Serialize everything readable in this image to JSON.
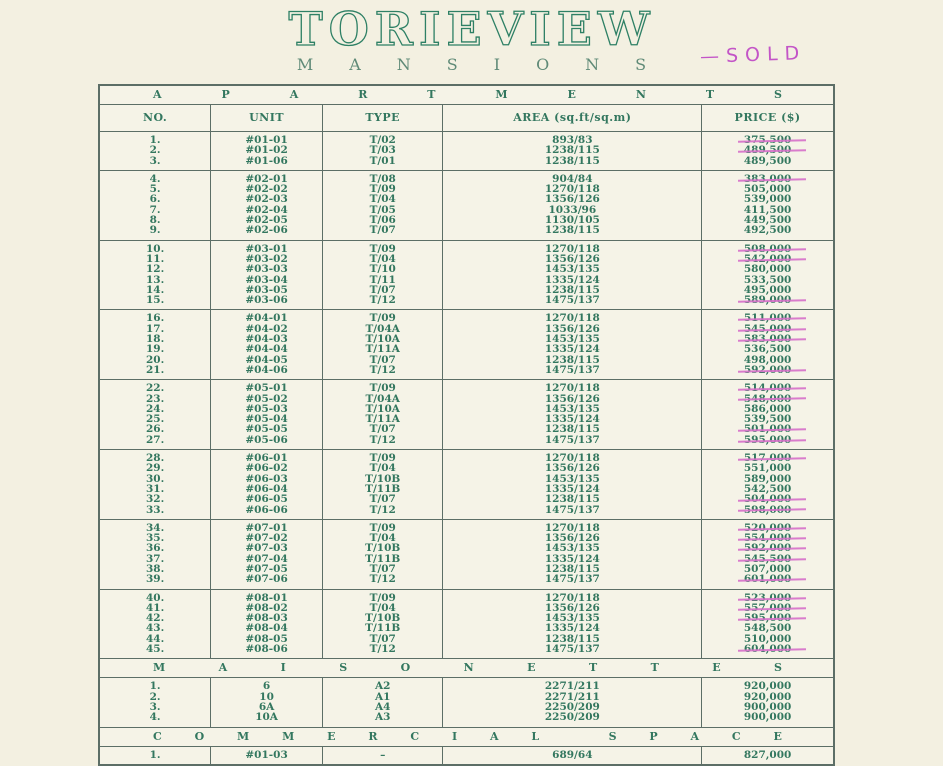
{
  "header": {
    "title": "TORIEVIEW",
    "subtitle": "MANSIONS",
    "sold_note": "—SOLD"
  },
  "colors": {
    "paper": "#f3f0e1",
    "ink_green": "#33775f",
    "border_green": "#5c6e66",
    "strike_pink": "#d66fc9",
    "sold_note_pink": "#c355c7"
  },
  "table": {
    "columns": [
      {
        "key": "no",
        "label": "NO."
      },
      {
        "key": "unit",
        "label": "UNIT"
      },
      {
        "key": "type",
        "label": "TYPE"
      },
      {
        "key": "area",
        "label": "AREA (sq.ft/sq.m)"
      },
      {
        "key": "price",
        "label": "PRICE ($)"
      }
    ],
    "sections": [
      {
        "id": "apartments",
        "title": "APARTMENTS",
        "show_columns": true,
        "groups": [
          [
            {
              "no": "1.",
              "unit": "#01-01",
              "type": "T/02",
              "area": "893/83",
              "price": "375,500",
              "sold": true
            },
            {
              "no": "2.",
              "unit": "#01-02",
              "type": "T/03",
              "area": "1238/115",
              "price": "489,500",
              "sold": true
            },
            {
              "no": "3.",
              "unit": "#01-06",
              "type": "T/01",
              "area": "1238/115",
              "price": "489,500",
              "sold": false
            }
          ],
          [
            {
              "no": "4.",
              "unit": "#02-01",
              "type": "T/08",
              "area": "904/84",
              "price": "383,000",
              "sold": true
            },
            {
              "no": "5.",
              "unit": "#02-02",
              "type": "T/09",
              "area": "1270/118",
              "price": "505,000",
              "sold": false
            },
            {
              "no": "6.",
              "unit": "#02-03",
              "type": "T/04",
              "area": "1356/126",
              "price": "539,000",
              "sold": false
            },
            {
              "no": "7.",
              "unit": "#02-04",
              "type": "T/05",
              "area": "1033/96",
              "price": "411,500",
              "sold": false
            },
            {
              "no": "8.",
              "unit": "#02-05",
              "type": "T/06",
              "area": "1130/105",
              "price": "449,500",
              "sold": false
            },
            {
              "no": "9.",
              "unit": "#02-06",
              "type": "T/07",
              "area": "1238/115",
              "price": "492,500",
              "sold": false
            }
          ],
          [
            {
              "no": "10.",
              "unit": "#03-01",
              "type": "T/09",
              "area": "1270/118",
              "price": "508,000",
              "sold": true
            },
            {
              "no": "11.",
              "unit": "#03-02",
              "type": "T/04",
              "area": "1356/126",
              "price": "542,000",
              "sold": true
            },
            {
              "no": "12.",
              "unit": "#03-03",
              "type": "T/10",
              "area": "1453/135",
              "price": "580,000",
              "sold": false
            },
            {
              "no": "13.",
              "unit": "#03-04",
              "type": "T/11",
              "area": "1335/124",
              "price": "533,500",
              "sold": false
            },
            {
              "no": "14.",
              "unit": "#03-05",
              "type": "T/07",
              "area": "1238/115",
              "price": "495,000",
              "sold": false
            },
            {
              "no": "15.",
              "unit": "#03-06",
              "type": "T/12",
              "area": "1475/137",
              "price": "589,000",
              "sold": true
            }
          ],
          [
            {
              "no": "16.",
              "unit": "#04-01",
              "type": "T/09",
              "area": "1270/118",
              "price": "511,000",
              "sold": true
            },
            {
              "no": "17.",
              "unit": "#04-02",
              "type": "T/04A",
              "area": "1356/126",
              "price": "545,000",
              "sold": true
            },
            {
              "no": "18.",
              "unit": "#04-03",
              "type": "T/10A",
              "area": "1453/135",
              "price": "583,000",
              "sold": true
            },
            {
              "no": "19.",
              "unit": "#04-04",
              "type": "T/11A",
              "area": "1335/124",
              "price": "536,500",
              "sold": false
            },
            {
              "no": "20.",
              "unit": "#04-05",
              "type": "T/07",
              "area": "1238/115",
              "price": "498,000",
              "sold": false
            },
            {
              "no": "21.",
              "unit": "#04-06",
              "type": "T/12",
              "area": "1475/137",
              "price": "592,000",
              "sold": true
            }
          ],
          [
            {
              "no": "22.",
              "unit": "#05-01",
              "type": "T/09",
              "area": "1270/118",
              "price": "514,000",
              "sold": true
            },
            {
              "no": "23.",
              "unit": "#05-02",
              "type": "T/04A",
              "area": "1356/126",
              "price": "548,000",
              "sold": true
            },
            {
              "no": "24.",
              "unit": "#05-03",
              "type": "T/10A",
              "area": "1453/135",
              "price": "586,000",
              "sold": false
            },
            {
              "no": "25.",
              "unit": "#05-04",
              "type": "T/11A",
              "area": "1335/124",
              "price": "539,500",
              "sold": false
            },
            {
              "no": "26.",
              "unit": "#05-05",
              "type": "T/07",
              "area": "1238/115",
              "price": "501,000",
              "sold": true
            },
            {
              "no": "27.",
              "unit": "#05-06",
              "type": "T/12",
              "area": "1475/137",
              "price": "595,000",
              "sold": true
            }
          ],
          [
            {
              "no": "28.",
              "unit": "#06-01",
              "type": "T/09",
              "area": "1270/118",
              "price": "517,000",
              "sold": true
            },
            {
              "no": "29.",
              "unit": "#06-02",
              "type": "T/04",
              "area": "1356/126",
              "price": "551,000",
              "sold": false
            },
            {
              "no": "30.",
              "unit": "#06-03",
              "type": "T/10B",
              "area": "1453/135",
              "price": "589,000",
              "sold": false
            },
            {
              "no": "31.",
              "unit": "#06-04",
              "type": "T/11B",
              "area": "1335/124",
              "price": "542,500",
              "sold": false
            },
            {
              "no": "32.",
              "unit": "#06-05",
              "type": "T/07",
              "area": "1238/115",
              "price": "504,000",
              "sold": true
            },
            {
              "no": "33.",
              "unit": "#06-06",
              "type": "T/12",
              "area": "1475/137",
              "price": "598,000",
              "sold": true
            }
          ],
          [
            {
              "no": "34.",
              "unit": "#07-01",
              "type": "T/09",
              "area": "1270/118",
              "price": "520,000",
              "sold": true
            },
            {
              "no": "35.",
              "unit": "#07-02",
              "type": "T/04",
              "area": "1356/126",
              "price": "554,000",
              "sold": true
            },
            {
              "no": "36.",
              "unit": "#07-03",
              "type": "T/10B",
              "area": "1453/135",
              "price": "592,000",
              "sold": true
            },
            {
              "no": "37.",
              "unit": "#07-04",
              "type": "T/11B",
              "area": "1335/124",
              "price": "545,500",
              "sold": true
            },
            {
              "no": "38.",
              "unit": "#07-05",
              "type": "T/07",
              "area": "1238/115",
              "price": "507,000",
              "sold": false
            },
            {
              "no": "39.",
              "unit": "#07-06",
              "type": "T/12",
              "area": "1475/137",
              "price": "601,000",
              "sold": true
            }
          ],
          [
            {
              "no": "40.",
              "unit": "#08-01",
              "type": "T/09",
              "area": "1270/118",
              "price": "523,000",
              "sold": true
            },
            {
              "no": "41.",
              "unit": "#08-02",
              "type": "T/04",
              "area": "1356/126",
              "price": "557,000",
              "sold": true
            },
            {
              "no": "42.",
              "unit": "#08-03",
              "type": "T/10B",
              "area": "1453/135",
              "price": "595,000",
              "sold": true
            },
            {
              "no": "43.",
              "unit": "#08-04",
              "type": "T/11B",
              "area": "1335/124",
              "price": "548,500",
              "sold": false
            },
            {
              "no": "44.",
              "unit": "#08-05",
              "type": "T/07",
              "area": "1238/115",
              "price": "510,000",
              "sold": false
            },
            {
              "no": "45.",
              "unit": "#08-06",
              "type": "T/12",
              "area": "1475/137",
              "price": "604,000",
              "sold": true
            }
          ]
        ]
      },
      {
        "id": "maisonettes",
        "title": "MAISONETTES",
        "show_columns": false,
        "groups": [
          [
            {
              "no": "1.",
              "unit": "6",
              "type": "A2",
              "area": "2271/211",
              "price": "920,000",
              "sold": false
            },
            {
              "no": "2.",
              "unit": "10",
              "type": "A1",
              "area": "2271/211",
              "price": "920,000",
              "sold": false
            },
            {
              "no": "3.",
              "unit": "6A",
              "type": "A4",
              "area": "2250/209",
              "price": "900,000",
              "sold": false
            },
            {
              "no": "4.",
              "unit": "10A",
              "type": "A3",
              "area": "2250/209",
              "price": "900,000",
              "sold": false
            }
          ]
        ]
      },
      {
        "id": "commercial-space",
        "title": "COMMERCIAL SPACE",
        "show_columns": false,
        "groups": [
          [
            {
              "no": "1.",
              "unit": "#01-03",
              "type": "–",
              "area": "689/64",
              "price": "827,000",
              "sold": false
            }
          ]
        ]
      }
    ]
  }
}
